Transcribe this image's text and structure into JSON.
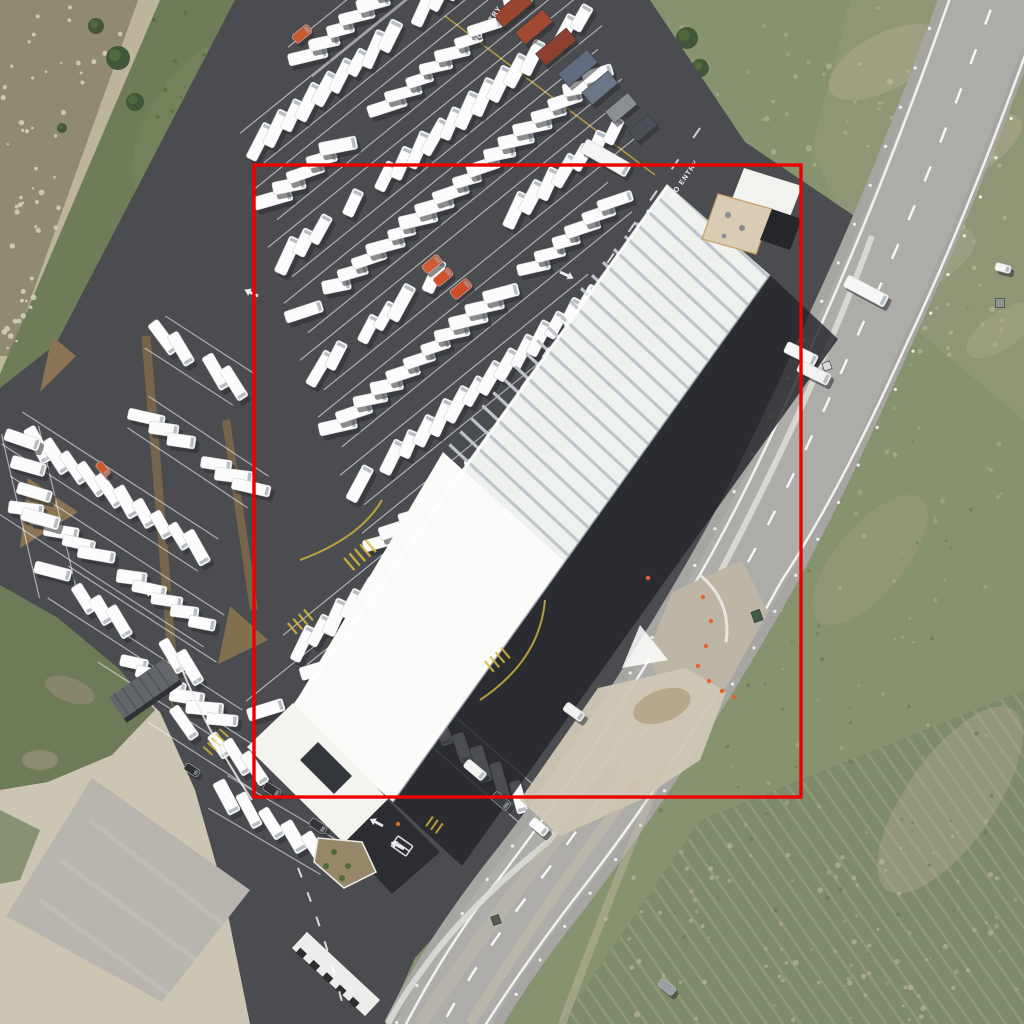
{
  "meta": {
    "type": "aerial-orthophoto",
    "subject": "RV dealership with large white warehouse, parking rows of white motorhomes, curved rural road and grass fields",
    "annotation_tool": "object bounding-box overlay"
  },
  "annotation": {
    "x": 254,
    "y": 165,
    "w": 547,
    "h": 632,
    "color": "#ee0000",
    "stroke_width": 3.4
  },
  "road_labels": [
    {
      "text": "NO ENTRY",
      "x": 686,
      "y": 180,
      "rot": -55
    },
    {
      "text": "NO ENTRY",
      "x": 489,
      "y": 26,
      "rot": -55
    }
  ],
  "palette": {
    "asphalt_lot": "#4b4c50",
    "road": "#a6a5a2",
    "roof": "#eff1ef",
    "showroom": "#fbfbf9",
    "grass_strip": "#6e7c57",
    "field": "#87926f",
    "dirt": "#cdc5b4",
    "gravel_pad": "#b7b5ae",
    "annotation_red": "#ee0000",
    "rv_white": "#fbfcfb",
    "shadow": "#2c2e33",
    "hedge": "#76644b",
    "yellow_marking": "#d8b93c",
    "container_rust": "#99452f",
    "container_blue": "#5f6b7e"
  },
  "scene": {
    "rv_rows": [
      [
        300,
        62,
        498,
        -98,
        24,
        21
      ],
      [
        252,
        148,
        520,
        -69,
        -24,
        21
      ],
      [
        265,
        205,
        560,
        -34,
        24,
        21
      ],
      [
        280,
        262,
        590,
        11,
        -24,
        21
      ],
      [
        296,
        318,
        610,
        64,
        24,
        21
      ],
      [
        312,
        375,
        626,
        121,
        -24,
        21
      ],
      [
        330,
        432,
        620,
        197,
        24,
        21
      ],
      [
        352,
        490,
        600,
        289,
        -24,
        21
      ],
      [
        374,
        548,
        580,
        381,
        24,
        21
      ],
      [
        295,
        650,
        400,
        565,
        -24,
        21
      ],
      [
        258,
        716,
        330,
        658,
        24,
        21
      ],
      [
        155,
        332,
        243,
        389,
        24,
        21
      ],
      [
        138,
        412,
        258,
        492,
        -24,
        21
      ],
      [
        12,
        428,
        208,
        555,
        24,
        21
      ],
      [
        0,
        492,
        214,
        631,
        -24,
        21
      ],
      [
        58,
        582,
        206,
        678,
        24,
        21
      ],
      [
        108,
        646,
        232,
        726,
        -24,
        21
      ],
      [
        158,
        706,
        262,
        773,
        24,
        21
      ],
      [
        20,
        430,
        58,
        594,
        -62,
        27
      ],
      [
        398,
        692,
        545,
        820,
        30,
        25
      ],
      [
        218,
        792,
        330,
        858,
        30,
        26
      ]
    ],
    "vehicles": [
      [
        866,
        291,
        28,
        46,
        13,
        "#f6f7f6"
      ],
      [
        801,
        354,
        26,
        34,
        12,
        "#f7f8f6"
      ],
      [
        814,
        373,
        26,
        34,
        12,
        "#f2f3f1"
      ],
      [
        606,
        158,
        30,
        52,
        15,
        "#f5f6f4"
      ],
      [
        539,
        827,
        40,
        20,
        10,
        "#fafaf9"
      ],
      [
        501,
        801,
        40,
        20,
        10,
        "#3c3e44"
      ],
      [
        574,
        712,
        36,
        22,
        10,
        "#f1f2ef"
      ],
      [
        1003,
        268,
        15,
        16,
        8,
        "#f4f4f2"
      ],
      [
        272,
        790,
        33,
        18,
        9,
        "#303237"
      ],
      [
        318,
        826,
        33,
        18,
        9,
        "#34363b"
      ],
      [
        192,
        770,
        33,
        16,
        8,
        "#2e3034"
      ],
      [
        432,
        264,
        -40,
        20,
        10,
        "#cf5a31"
      ],
      [
        443,
        277,
        -40,
        20,
        10,
        "#d4502a"
      ],
      [
        461,
        289,
        -40,
        22,
        11,
        "#cc4e28"
      ],
      [
        103,
        469,
        50,
        16,
        8,
        "#d0592f"
      ],
      [
        302,
        34,
        -40,
        20,
        10,
        "#c95a30"
      ],
      [
        667,
        987,
        40,
        18,
        9,
        "#9b9da0"
      ],
      [
        475,
        770,
        40,
        24,
        10,
        "#f3f4f2"
      ]
    ],
    "containers": [
      [
        513,
        9,
        50,
        16,
        38,
        "#99452f"
      ],
      [
        534,
        27,
        50,
        16,
        36,
        "#a14a33"
      ],
      [
        556,
        47,
        50,
        16,
        40,
        "#8e4030"
      ],
      [
        578,
        68,
        50,
        17,
        38,
        "#5f6b7e"
      ],
      [
        600,
        88,
        50,
        16,
        34,
        "#6b7688"
      ],
      [
        621,
        108,
        50,
        15,
        30,
        "#8b8e93"
      ],
      [
        643,
        128,
        50,
        14,
        26,
        "#4a4e55"
      ]
    ],
    "cones": [
      [
        703,
        597
      ],
      [
        711,
        621
      ],
      [
        706,
        646
      ],
      [
        698,
        666
      ],
      [
        709,
        681
      ],
      [
        722,
        691
      ],
      [
        734,
        697
      ],
      [
        398,
        824
      ],
      [
        648,
        578
      ]
    ],
    "boxes": [
      [
        1000,
        303,
        9,
        9,
        0,
        "#8f9392"
      ],
      [
        827,
        366,
        8,
        8,
        -20,
        "#d8d8d4"
      ],
      [
        757,
        616,
        9,
        11,
        -20,
        "#3f5a46"
      ],
      [
        496,
        920,
        8,
        9,
        -20,
        "#555e4e"
      ]
    ],
    "trees": [
      [
        118,
        58,
        12
      ],
      [
        135,
        102,
        9
      ],
      [
        96,
        26,
        8
      ],
      [
        687,
        38,
        11
      ],
      [
        700,
        68,
        9
      ],
      [
        686,
        92,
        7
      ],
      [
        62,
        128,
        5
      ]
    ],
    "arrows": [
      [
        258,
        296,
        205
      ],
      [
        158,
        598,
        210
      ],
      [
        96,
        610,
        210
      ],
      [
        383,
        826,
        208
      ],
      [
        404,
        849,
        208
      ],
      [
        560,
        272,
        25
      ]
    ],
    "speckle_sets": [
      {
        "count": 55,
        "seed": 5,
        "x": 2,
        "y": 2,
        "w": 130,
        "h": 348,
        "slope": -0.33,
        "color": "#d7d2c0",
        "rmin": 1.1,
        "rmax": 2.9,
        "op": 0.85
      },
      {
        "count": 170,
        "seed": 9,
        "x": 660,
        "y": 0,
        "w": 360,
        "h": 1020,
        "slope": 0,
        "color": "#c2b99f",
        "rmin": 1.0,
        "rmax": 2.6,
        "op": 0.4
      },
      {
        "count": 80,
        "seed": 13,
        "x": 700,
        "y": 60,
        "w": 310,
        "h": 300,
        "slope": 0,
        "color": "#cfc6ac",
        "rmin": 1.2,
        "rmax": 3.2,
        "op": 0.45
      },
      {
        "count": 70,
        "seed": 21,
        "x": 560,
        "y": 830,
        "w": 440,
        "h": 190,
        "slope": 0,
        "color": "#cdc4aa",
        "rmin": 1.2,
        "rmax": 3.0,
        "op": 0.5
      },
      {
        "count": 60,
        "seed": 31,
        "x": 150,
        "y": 0,
        "w": 120,
        "h": 360,
        "slope": -0.2,
        "color": "#55663f",
        "rmin": 1.0,
        "rmax": 2.4,
        "op": 0.6
      },
      {
        "count": 60,
        "seed": 41,
        "x": 660,
        "y": 300,
        "w": 340,
        "h": 700,
        "slope": 0,
        "color": "#5d6b4a",
        "rmin": 1.0,
        "rmax": 2.4,
        "op": 0.5
      }
    ],
    "plants": [
      [
        334,
        852
      ],
      [
        348,
        866
      ],
      [
        326,
        866
      ],
      [
        342,
        878
      ]
    ]
  }
}
